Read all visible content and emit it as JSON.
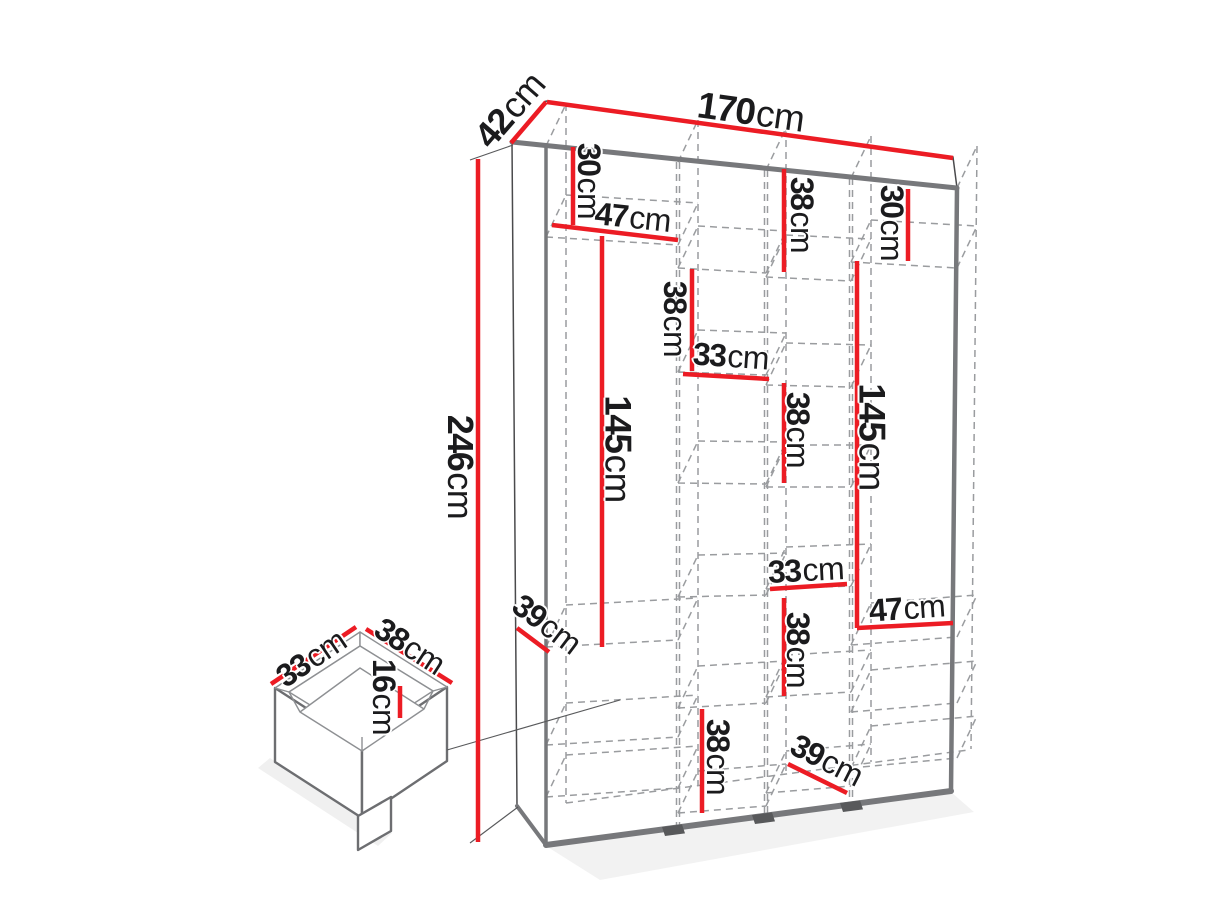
{
  "unit": "cm",
  "wardrobe": {
    "width": "170cm",
    "depth": "42cm",
    "height": "246cm"
  },
  "drawer": {
    "width": "33cm",
    "depth": "38cm",
    "height": "16cm"
  },
  "labels": [
    {
      "value": "42",
      "unit": "cm",
      "part": "wardrobe-top-depth"
    },
    {
      "value": "170",
      "unit": "cm",
      "part": "wardrobe-top-width"
    },
    {
      "value": "30",
      "unit": "cm",
      "part": "top-left-section-height"
    },
    {
      "value": "47",
      "unit": "cm",
      "part": "left-section-width"
    },
    {
      "value": "38",
      "unit": "cm",
      "part": "top-third-column-section-height"
    },
    {
      "value": "30",
      "unit": "cm",
      "part": "top-right-section-height"
    },
    {
      "value": "246",
      "unit": "cm",
      "part": "wardrobe-height"
    },
    {
      "value": "145",
      "unit": "cm",
      "part": "left-hanging-section-height"
    },
    {
      "value": "38",
      "unit": "cm",
      "part": "second-column-upper-section-height"
    },
    {
      "value": "33",
      "unit": "cm",
      "part": "second-column-width"
    },
    {
      "value": "38",
      "unit": "cm",
      "part": "third-column-middle-section-height"
    },
    {
      "value": "145",
      "unit": "cm",
      "part": "right-hanging-section-height"
    },
    {
      "value": "33",
      "unit": "cm",
      "part": "third-column-width"
    },
    {
      "value": "47",
      "unit": "cm",
      "part": "right-section-width"
    },
    {
      "value": "38",
      "unit": "cm",
      "part": "third-column-lower-section-height"
    },
    {
      "value": "39",
      "unit": "cm",
      "part": "left-shelf-depth"
    },
    {
      "value": "38",
      "unit": "cm",
      "part": "second-column-bottom-section-height"
    },
    {
      "value": "39",
      "unit": "cm",
      "part": "right-shelf-depth"
    },
    {
      "value": "33",
      "unit": "cm",
      "part": "drawer-width"
    },
    {
      "value": "38",
      "unit": "cm",
      "part": "drawer-depth"
    },
    {
      "value": "16",
      "unit": "cm",
      "part": "drawer-height"
    }
  ]
}
